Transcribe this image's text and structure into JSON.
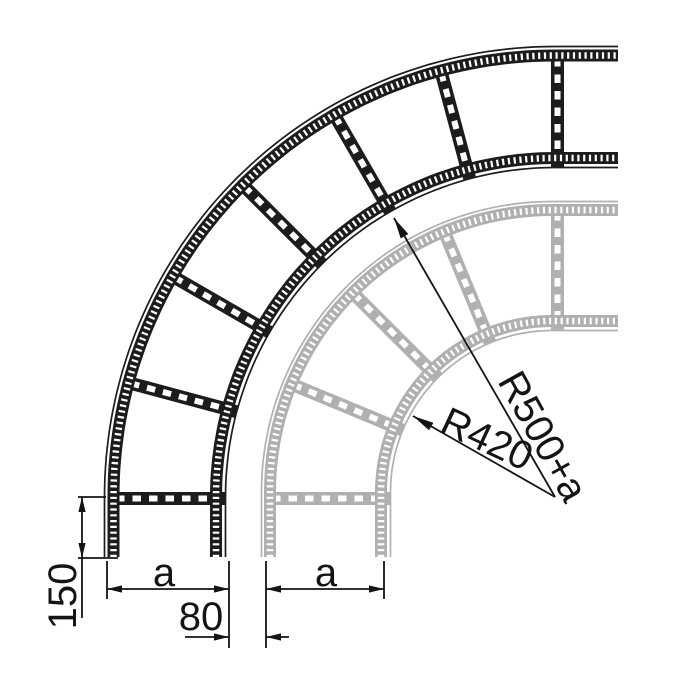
{
  "drawing": {
    "subject": "cable-ladder-90-degree-bend",
    "colors": {
      "primary_part": "#1c1c1c",
      "secondary_part": "#b0b0b0",
      "dimension_ink": "#141414",
      "background": "#ffffff"
    },
    "labels": {
      "tangent_length": "150",
      "front_width": "a",
      "rail_gap": "80",
      "back_width": "a",
      "back_radius": "R420",
      "front_radius": "R500+a"
    }
  }
}
